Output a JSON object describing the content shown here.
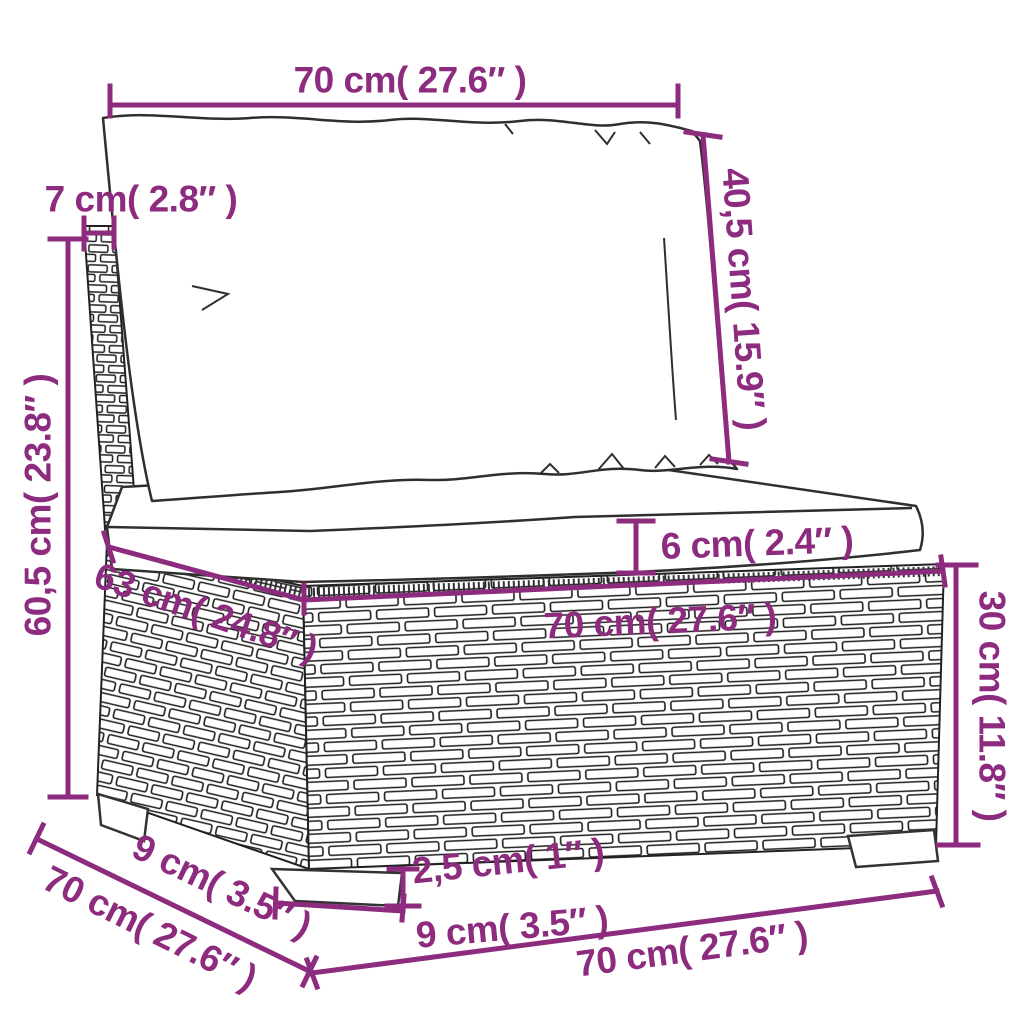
{
  "diagram": {
    "kind": "product-dimension-diagram",
    "product": "rattan-garden-sofa-middle-section-with-cushions",
    "background_color": "#ffffff",
    "accent_color": "#8d2b7e",
    "line_color": "#2a2a2a",
    "labels": {
      "cushion_width_top": "70 cm( 27.6″ )",
      "backrest_thickness": "7 cm( 2.8″ )",
      "back_cushion_height": "40,5 cm( 15.9″ )",
      "total_height": "60,5 cm( 23.8″ )",
      "seat_cushion_thickness": "6 cm( 2.4″ )",
      "seat_depth": "63 cm( 24.8″ )",
      "base_width": "70 cm( 27.6″ )",
      "base_height": "30 cm( 11.8″ )",
      "foot_depth": "9 cm( 3.5″ )",
      "total_depth": "70 cm( 27.6″ )",
      "foot_height": "2,5 cm( 1″ )",
      "foot_width": "9 cm( 3.5″ )",
      "bottom_width": "70 cm( 27.6″ )"
    }
  }
}
